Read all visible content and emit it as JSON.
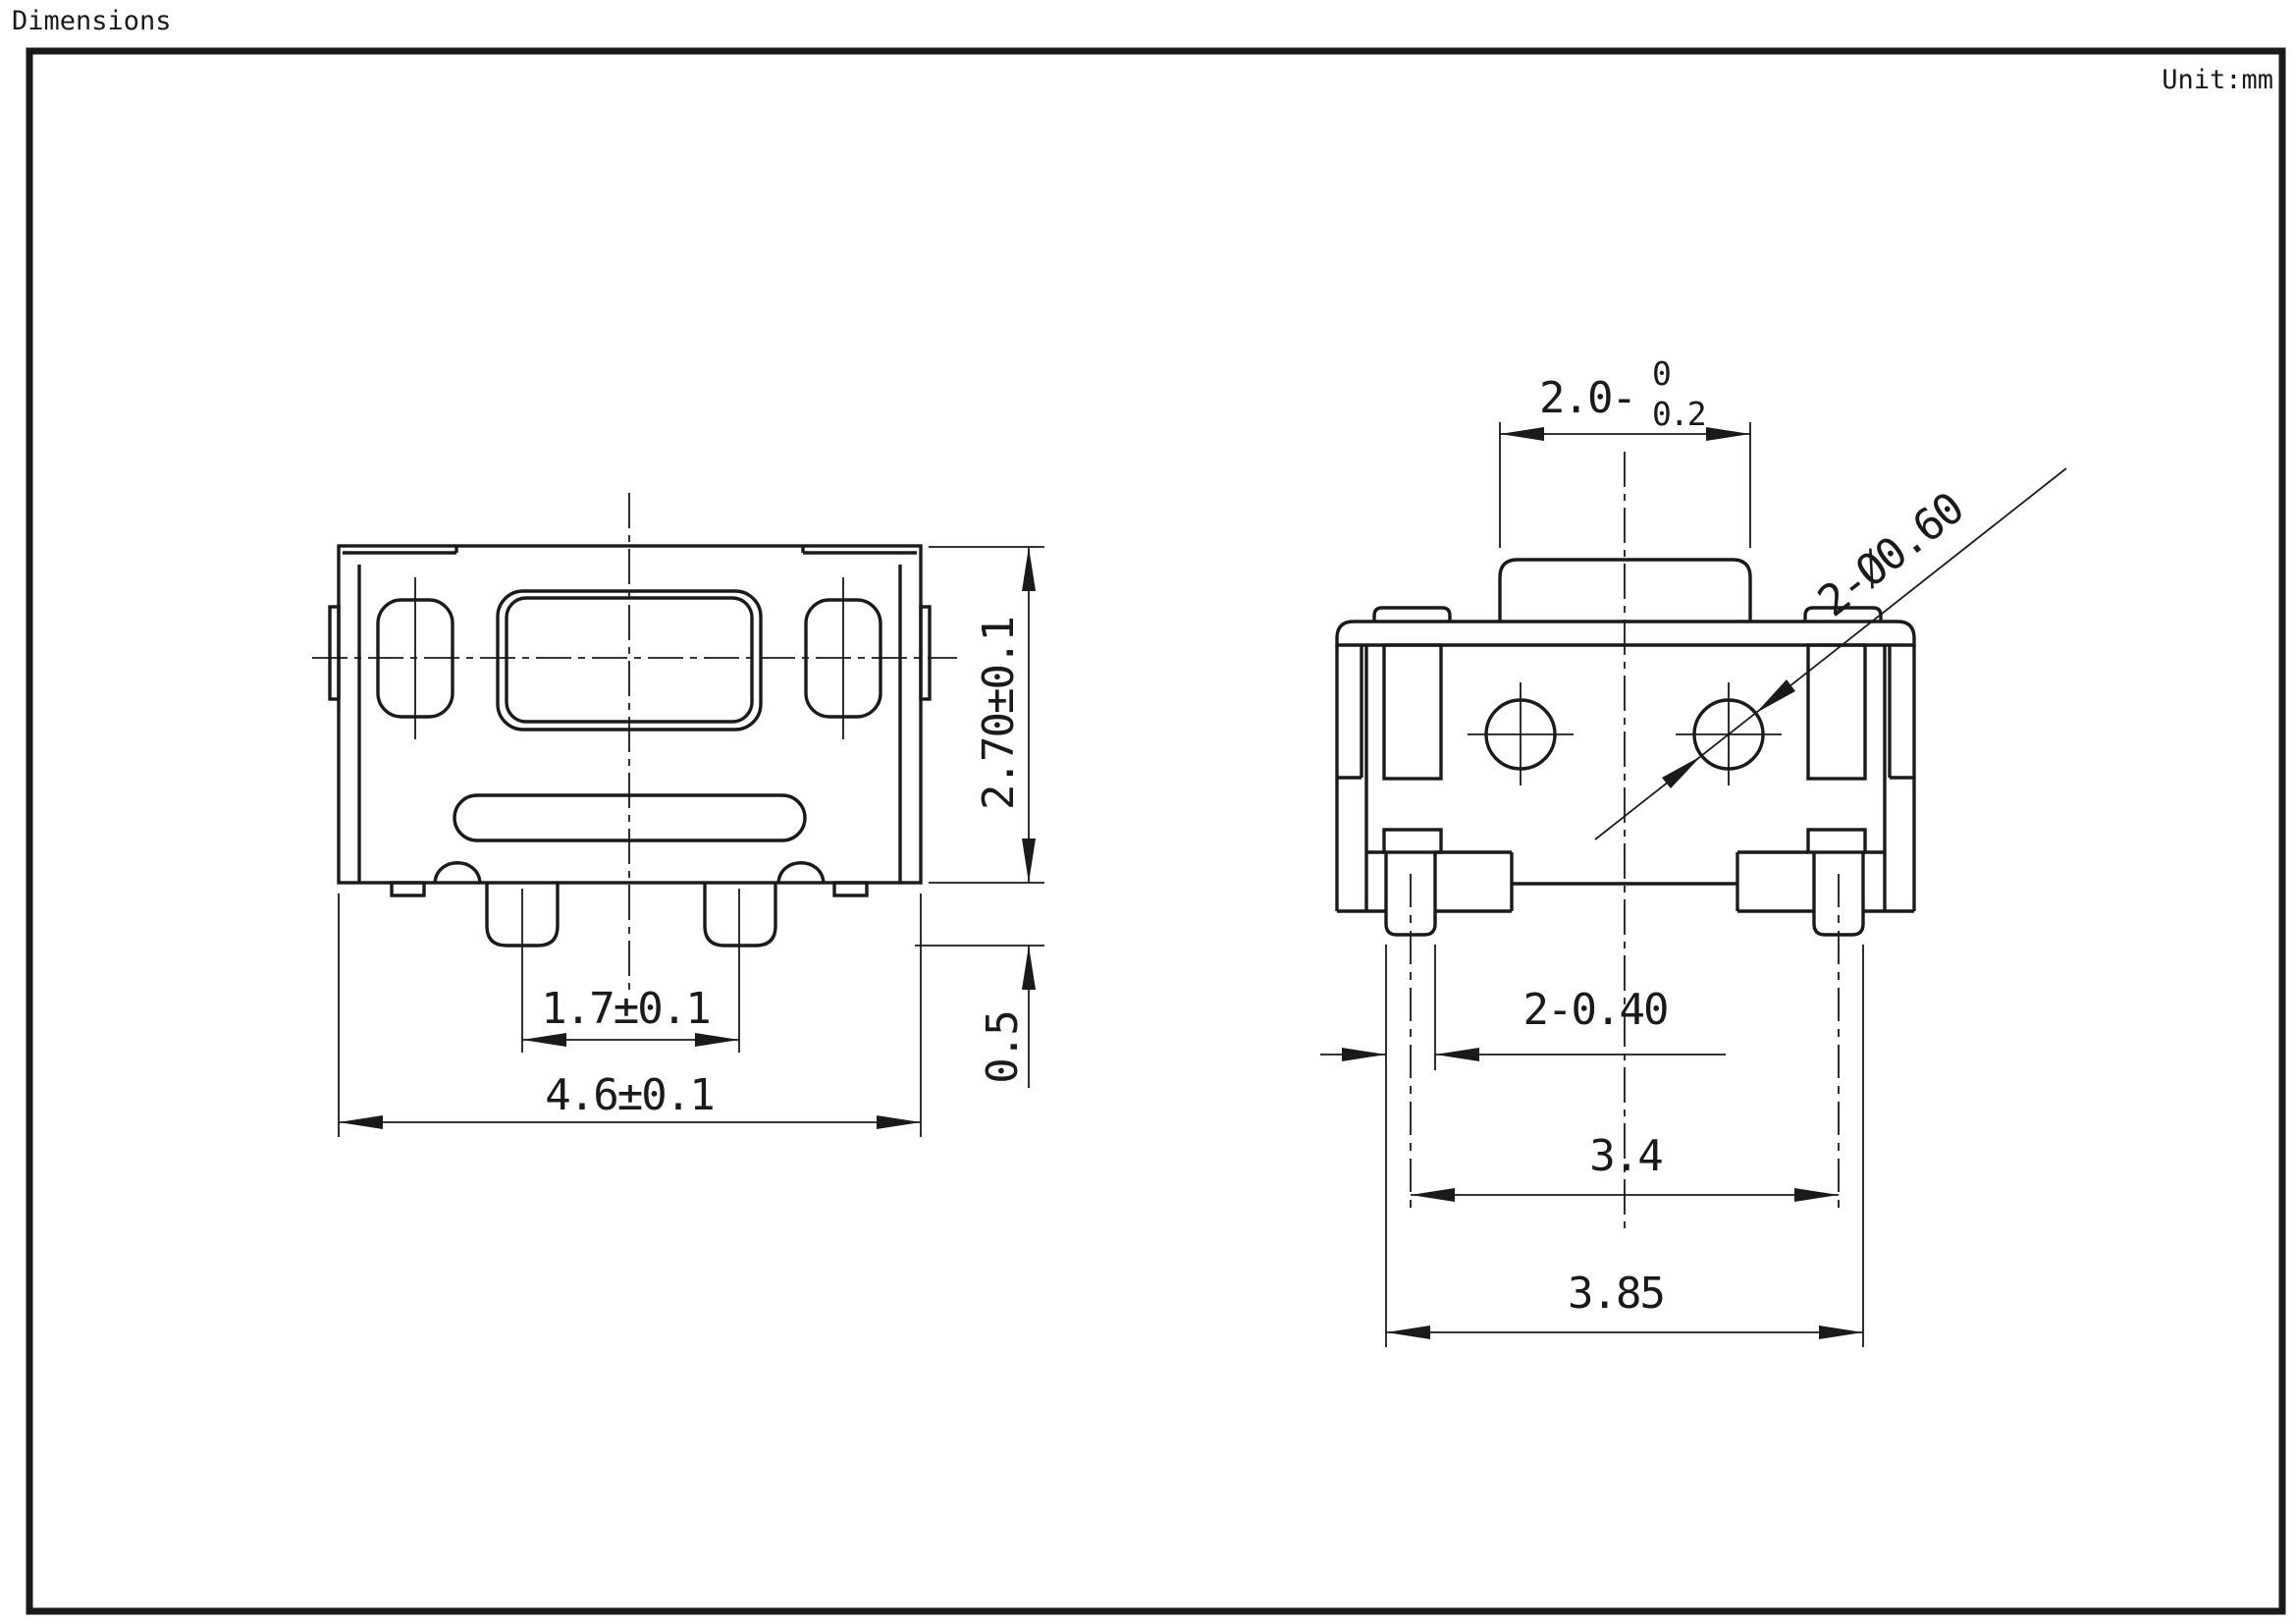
{
  "page": {
    "title": "Dimensions",
    "unit_label": "Unit:mm"
  },
  "colors": {
    "line": "#1a1a1a",
    "background": "#ffffff"
  },
  "left_view": {
    "description": "top view of SMD tact switch",
    "dims": {
      "body_height": "2.70±0.1",
      "leg_height": "0.5",
      "leg_pitch": "1.7±0.1",
      "body_width": "4.6±0.1"
    }
  },
  "right_view": {
    "description": "front view of SMD tact switch",
    "dims": {
      "stem_width": "2.0",
      "stem_tol_sign": "-",
      "stem_tol_upper": "0",
      "stem_tol_lower": "0.2",
      "hole_callout": "2-Ø0.60",
      "pin_width": "2-0.40",
      "pin_pitch": "3.4",
      "pin_span": "3.85"
    }
  }
}
